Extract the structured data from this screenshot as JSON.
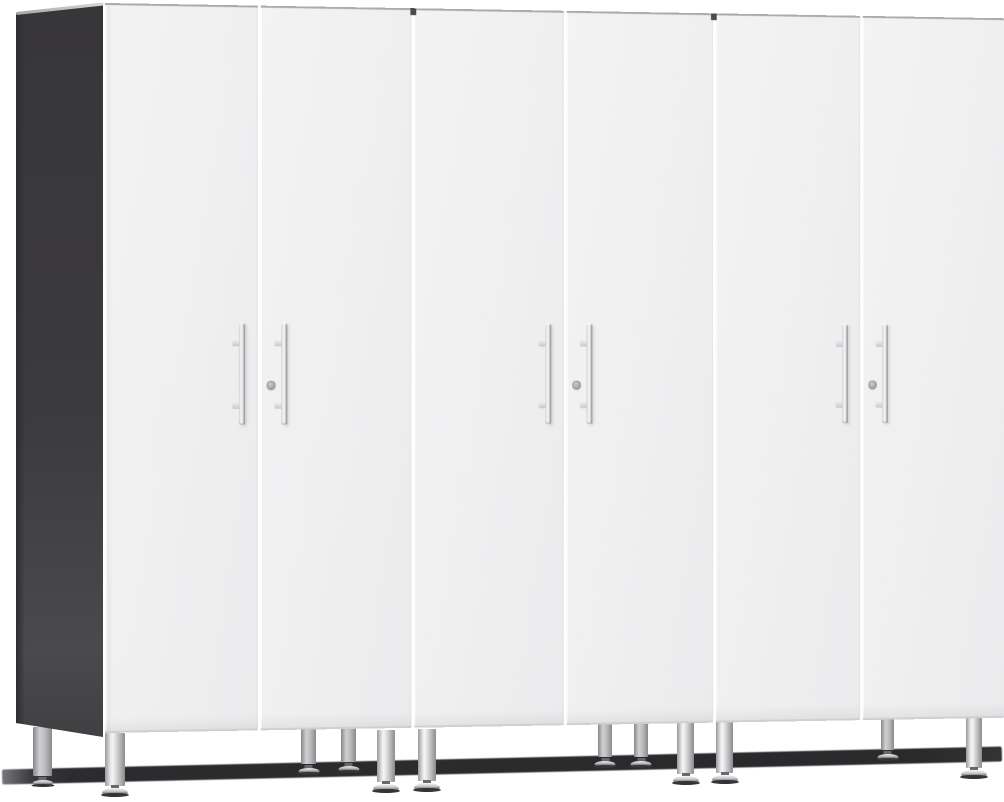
{
  "scene": {
    "type": "product-photo",
    "description": "Three-piece tall two-door storage cabinet set in white with a dark charcoal left side panel, vertical chrome bar handles, keyed lock cylinders, and silver adjustable leveling legs over a dark floor shadow",
    "background_color": "#ffffff",
    "visible_text": ""
  },
  "colors": {
    "door_face": "#f0f0f1",
    "door_seam_gap": "#ffffff",
    "door_top_edge": "#ababad",
    "door_bottom_edge": "#cfcfd1",
    "side_panel": "#3b3a3c",
    "side_panel_bevel": "#c9c9cb",
    "handle_chrome_light": "#fbfbfc",
    "handle_chrome_dark": "#86868a",
    "lock_cylinder": "#a7a7a9",
    "leg_silver": "#d2d2d4",
    "leg_edge": "#8b8b8d",
    "foot_base": "#343335",
    "floor_shadow": "#2c2b2d"
  },
  "cabinet_set": {
    "cabinet_count": 3,
    "doors_per_cabinet": 2,
    "total_doors": 6,
    "handle_style": "vertical chrome bar with two mount posts",
    "lock_per_cabinet": 1,
    "legs_per_cabinet": 4
  },
  "doors": [
    {
      "cabinet": 1,
      "position": "left",
      "has_handle": true,
      "has_lock": false
    },
    {
      "cabinet": 1,
      "position": "right",
      "has_handle": true,
      "has_lock": true
    },
    {
      "cabinet": 2,
      "position": "left",
      "has_handle": true,
      "has_lock": false
    },
    {
      "cabinet": 2,
      "position": "right",
      "has_handle": true,
      "has_lock": true
    },
    {
      "cabinet": 3,
      "position": "left",
      "has_handle": true,
      "has_lock": false
    },
    {
      "cabinet": 3,
      "position": "right",
      "has_handle": true,
      "has_lock": true
    }
  ],
  "handle_geometry": {
    "top": 317,
    "height": 103,
    "width": 6,
    "left_door_offset_right": 13,
    "right_door_offset_left": 21,
    "lock_top": 376,
    "lock_left": 6
  },
  "cabinet_gaps": [
    {
      "left": 310
    },
    {
      "left": 624
    }
  ],
  "legs": [
    {
      "id": "cab1-back-left",
      "type": "back",
      "x": 33,
      "y": 727,
      "w": 19,
      "h": 49
    },
    {
      "id": "cab1-back-right",
      "type": "back",
      "x": 301,
      "y": 725,
      "w": 15,
      "h": 39
    },
    {
      "id": "cab2-back-left",
      "type": "back",
      "x": 341,
      "y": 724,
      "w": 15,
      "h": 38
    },
    {
      "id": "cab2-back-right",
      "type": "back",
      "x": 598,
      "y": 722,
      "w": 14,
      "h": 35
    },
    {
      "id": "cab3-back-left",
      "type": "back",
      "x": 634,
      "y": 722,
      "w": 14,
      "h": 35
    },
    {
      "id": "cab3-back-right",
      "type": "back",
      "x": 881,
      "y": 719,
      "w": 13,
      "h": 31
    },
    {
      "id": "cab1-front-left",
      "type": "front",
      "x": 105,
      "y": 733,
      "w": 20,
      "h": 53
    },
    {
      "id": "cab1-front-right",
      "type": "front",
      "x": 377,
      "y": 730,
      "w": 18,
      "h": 52
    },
    {
      "id": "cab2-front-left",
      "type": "front",
      "x": 418,
      "y": 729,
      "w": 18,
      "h": 52
    },
    {
      "id": "cab2-front-right",
      "type": "front",
      "x": 677,
      "y": 722,
      "w": 17,
      "h": 52
    },
    {
      "id": "cab3-front-left",
      "type": "front",
      "x": 716,
      "y": 721,
      "w": 17,
      "h": 52
    },
    {
      "id": "cab3-front-right",
      "type": "front",
      "x": 966,
      "y": 718,
      "w": 16,
      "h": 50
    }
  ]
}
